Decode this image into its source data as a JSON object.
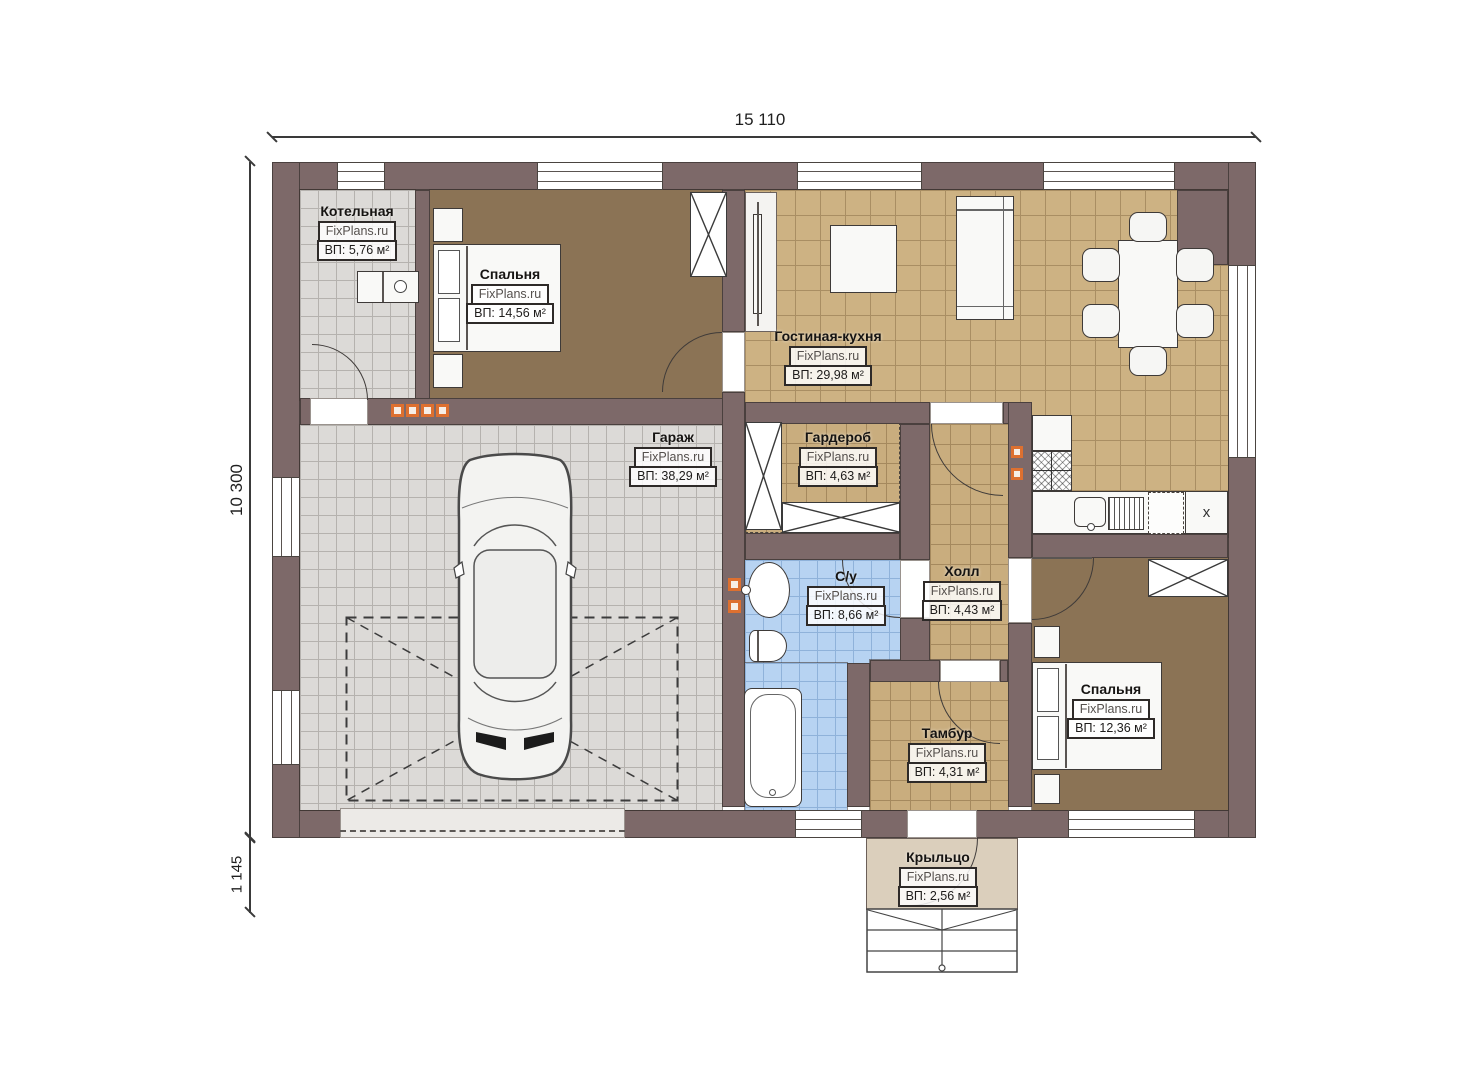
{
  "brand": "FixPlans.ru",
  "dimensions": {
    "width_top": "15 110",
    "height_left": "10 300",
    "porch_depth": "1 145"
  },
  "rooms": [
    {
      "name": "Котельная",
      "area": "ВП: 5,76 м²"
    },
    {
      "name": "Спальня",
      "area": "ВП: 14,56 м²"
    },
    {
      "name": "Гостиная-кухня",
      "area": "ВП: 29,98 м²"
    },
    {
      "name": "Гараж",
      "area": "ВП: 38,29 м²"
    },
    {
      "name": "Гардероб",
      "area": "ВП: 4,63 м²"
    },
    {
      "name": "С/у",
      "area": "ВП: 8,66 м²"
    },
    {
      "name": "Холл",
      "area": "ВП: 4,43 м²"
    },
    {
      "name": "Тамбур",
      "area": "ВП: 4,31 м²"
    },
    {
      "name": "Спальня",
      "area": "ВП: 12,36 м²"
    },
    {
      "name": "Крыльцо",
      "area": "ВП: 2,56 м²"
    }
  ],
  "markers": {
    "kitchen_x": "х"
  },
  "colors": {
    "wall": "#7d6969",
    "tile_beige": "#cdb283",
    "tile_gray": "#dcdad7",
    "tile_blue": "#b7d3f2",
    "floor_brown": "#8b7355",
    "porch": "#dbcfbc",
    "accent_orange": "#dd7030"
  }
}
